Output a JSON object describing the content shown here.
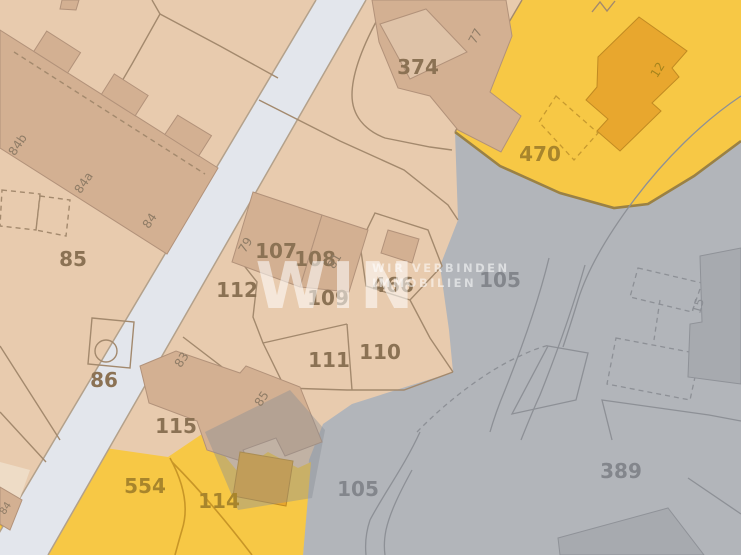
{
  "map": {
    "type": "cadastral-parcel-map",
    "watermark": {
      "brand": "WIN",
      "tagline_line1": "WIR VERBINDEN",
      "tagline_line2": "IMMOBILIEN"
    },
    "labels": [
      {
        "text": "374",
        "kind": "parcel-number"
      },
      {
        "text": "470",
        "kind": "parcel-number-highlighted"
      },
      {
        "text": "85",
        "kind": "parcel-number"
      },
      {
        "text": "86",
        "kind": "parcel-number"
      },
      {
        "text": "112",
        "kind": "parcel-number"
      },
      {
        "text": "107",
        "kind": "parcel-number"
      },
      {
        "text": "108",
        "kind": "parcel-number"
      },
      {
        "text": "109",
        "kind": "parcel-number"
      },
      {
        "text": "466",
        "kind": "parcel-number"
      },
      {
        "text": "110",
        "kind": "parcel-number"
      },
      {
        "text": "111",
        "kind": "parcel-number"
      },
      {
        "text": "115",
        "kind": "parcel-number"
      },
      {
        "text": "554",
        "kind": "parcel-number-highlighted"
      },
      {
        "text": "114",
        "kind": "parcel-number-highlighted"
      },
      {
        "text": "105",
        "kind": "parcel-number-gray-zone"
      },
      {
        "text": "105",
        "kind": "parcel-number-gray-zone"
      },
      {
        "text": "389",
        "kind": "parcel-number-gray-zone"
      },
      {
        "text": "84b",
        "kind": "house-number"
      },
      {
        "text": "84a",
        "kind": "house-number"
      },
      {
        "text": "84",
        "kind": "house-number"
      },
      {
        "text": "79",
        "kind": "house-number"
      },
      {
        "text": "81",
        "kind": "house-number"
      },
      {
        "text": "83",
        "kind": "house-number"
      },
      {
        "text": "85",
        "kind": "house-number"
      },
      {
        "text": "77",
        "kind": "house-number"
      },
      {
        "text": "12",
        "kind": "house-number-highlighted"
      },
      {
        "text": "15",
        "kind": "house-number-gray-zone"
      },
      {
        "text": "84",
        "kind": "house-number-edge-clipped"
      }
    ],
    "colors": {
      "parcel_tan": "#e8cbae",
      "building_tan": "#d3b092",
      "building_tan_light": "#dfc3a8",
      "road_gray": "#e3e6ec",
      "zone_gray": "#b2b5ba",
      "zone_gray_building": "#a7aaaf",
      "highlight_yellow": "#f7c845",
      "highlight_building_orange": "#e8a72e",
      "boundary_line_brown": "#a3896d",
      "boundary_line_gray": "#8d9096",
      "label_brown": "#8b7254",
      "label_gold": "#a8852c",
      "label_gray": "#83868c",
      "watermark_white": "rgba(255,255,255,0.55)"
    }
  }
}
